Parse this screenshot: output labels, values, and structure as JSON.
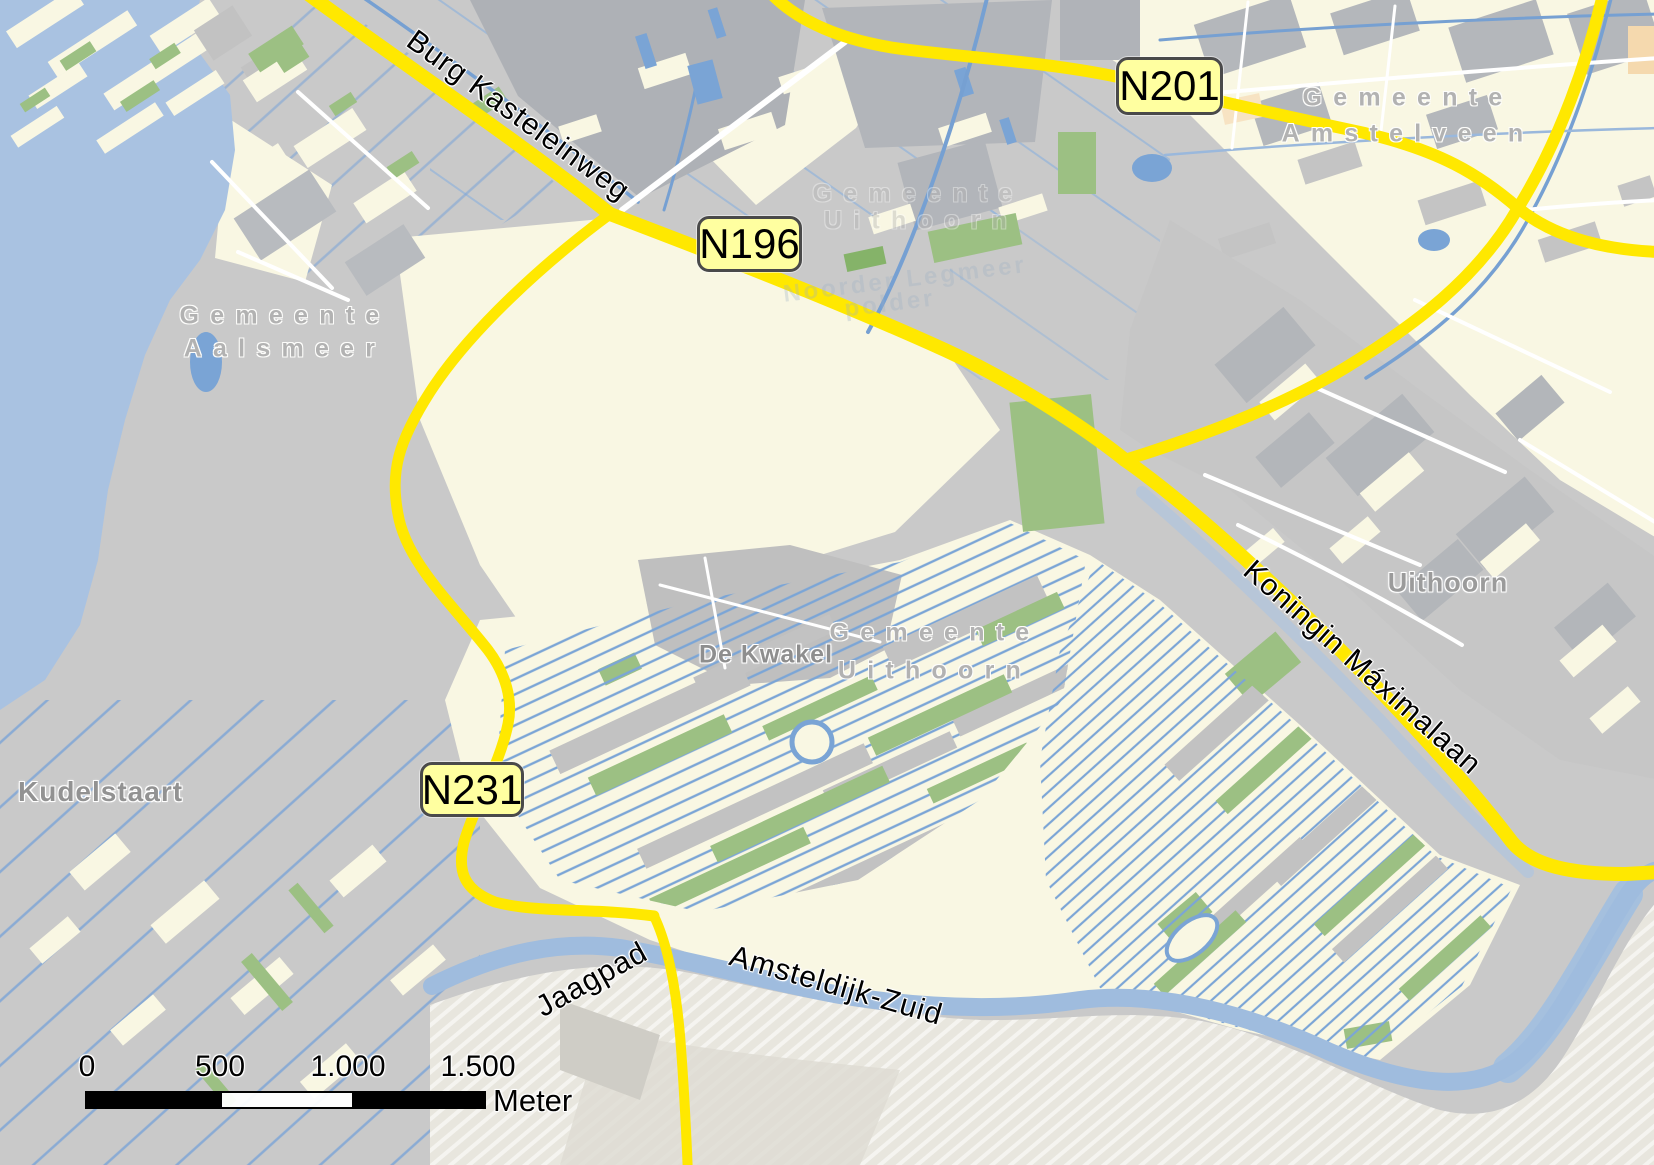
{
  "map_title": "Road map of Uithoorn / Aalsmeer / Amstelveen area",
  "badges": {
    "n201": "N201",
    "n196": "N196",
    "n231": "N231"
  },
  "labels": {
    "burg_kasteleinweg": "Burg Kasteleinweg",
    "koningin_maximalaan": "Koningin Máximalaan",
    "jaagpad": "Jaagpad",
    "amsteldijk_zuid": "Amsteldijk-Zuid",
    "gemeente_amstelveen": {
      "line1": "Gemeente",
      "line2": "Amstelveen"
    },
    "gemeente_aalsmeer": {
      "line1": "Gemeente",
      "line2": "Aalsmeer"
    },
    "gemeente_uithoorn": {
      "line1": "Gemeente",
      "line2": "Uithoorn"
    },
    "gemeente_uithoorn_faint": {
      "line1": "Gemeente",
      "line2": "Uithoorn"
    },
    "polder_watermark": {
      "line1": "Noorder Legmeer",
      "line2": "polder"
    },
    "uithoorn": "Uithoorn",
    "kudelstaart": "Kudelstaart",
    "de_kwakel": "De Kwakel"
  },
  "scale_bar": {
    "ticks": [
      "0",
      "500",
      "1.000",
      "1.500"
    ],
    "unit": "Meter"
  },
  "colors": {
    "road_yellow": "#ffe800",
    "badge_fill": "#ffffa0",
    "badge_border": "#4a4a4a",
    "water_lake": "#a9c2e1",
    "canal_blue": "#76a0d2",
    "urban_gray": "#c9c9c9",
    "field_cream": "#f9f7e3",
    "green_area": "#9cc083",
    "label_gray": "#b2b2b2"
  }
}
